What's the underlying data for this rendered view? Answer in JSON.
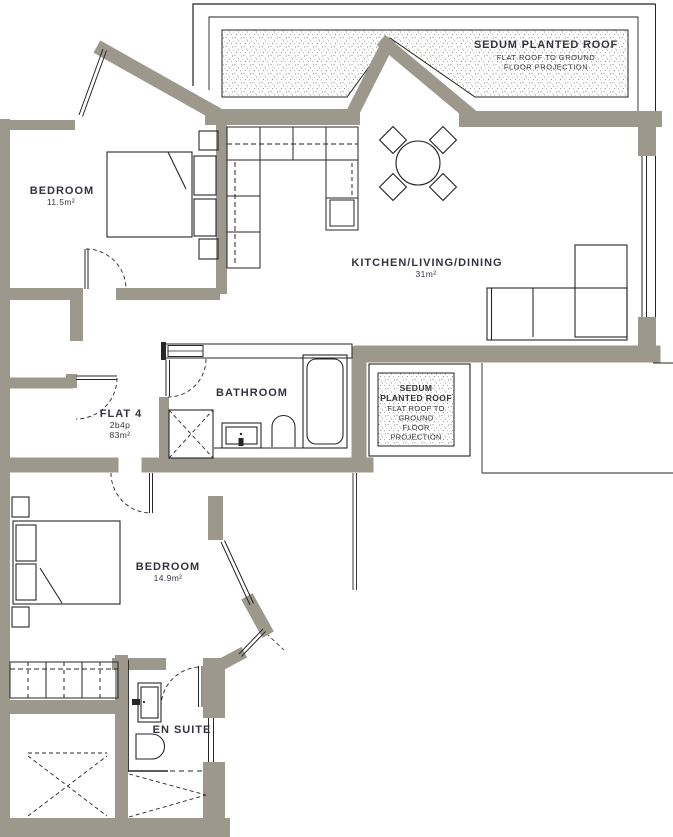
{
  "flat": {
    "name": "FLAT 4",
    "spec": "2b4p",
    "area": "83m²"
  },
  "rooms": {
    "bedroom1": {
      "label": "BEDROOM",
      "area": "11.5m²"
    },
    "kitchen": {
      "label": "KITCHEN/LIVING/DINING",
      "area": "31m²"
    },
    "bathroom": {
      "label": "BATHROOM"
    },
    "bedroom2": {
      "label": "BEDROOM",
      "area": "14.9m²"
    },
    "ensuite": {
      "label": "EN SUITE"
    }
  },
  "roof_labels": {
    "top": {
      "title": "SEDUM PLANTED ROOF",
      "sub1": "FLAT ROOF TO GROUND",
      "sub2": "FLOOR PROJECTION"
    },
    "mid": {
      "l1": "SEDUM",
      "l2": "PLANTED ROOF",
      "l3": "FLAT ROOF TO",
      "l4": "GROUND",
      "l5": "FLOOR",
      "l6": "PROJECTION"
    }
  },
  "colors": {
    "wall": "#9c988b",
    "line": "#26262a",
    "text": "#34343e",
    "stipple": "#6d7268",
    "background": "#ffffff"
  }
}
